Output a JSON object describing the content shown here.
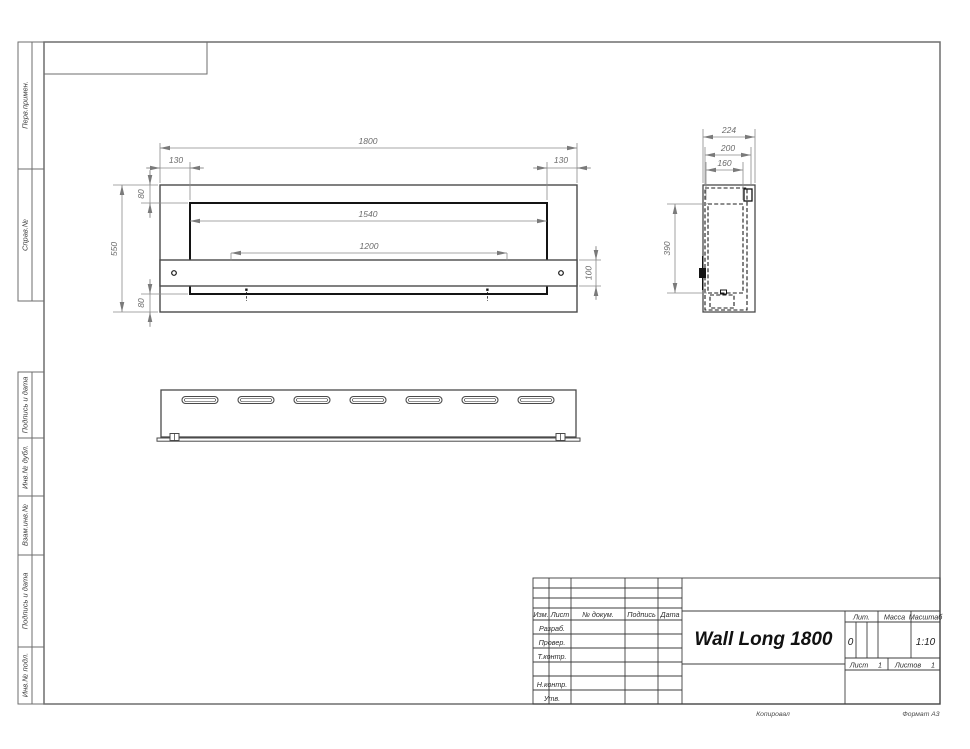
{
  "sheet": {
    "copied_label": "Копировал",
    "format_label": "Формат А3"
  },
  "margin": {
    "boxes": [
      {
        "label": "Перв.примен."
      },
      {
        "label": "Справ.№"
      },
      {
        "label": "Подпись и дата"
      },
      {
        "label": "Инв.№ дубл."
      },
      {
        "label": "Взам.инв.№"
      },
      {
        "label": "Подпись и дата"
      },
      {
        "label": "Инв.№ подл."
      }
    ]
  },
  "title_block": {
    "title": "Wall Long 1800",
    "columns": {
      "izm": "Изм.",
      "list": "Лист",
      "doc": "№ докум.",
      "sign": "Подпись",
      "date": "Дата"
    },
    "rows": {
      "developed": "Разраб.",
      "checked": "Провер.",
      "tcontrol": "Т.контр.",
      "ncontrol": "Н.контр.",
      "approved": "Утв."
    },
    "lit": {
      "label": "Лит.",
      "value": "0"
    },
    "mass": {
      "label": "Масса",
      "value": ""
    },
    "scale": {
      "label": "Масштаб",
      "value": "1:10"
    },
    "sheet_no": {
      "label": "Лист",
      "value": "1"
    },
    "sheets_total": {
      "label": "Листов",
      "value": "1"
    }
  },
  "views": {
    "front": {
      "dims": {
        "overall_width": "1800",
        "inset_left": "130",
        "inset_right": "130",
        "opening_width": "1540",
        "burner_width": "1200",
        "overall_height": "550",
        "top_offset": "80",
        "bottom_offset": "80",
        "strip_height": "100"
      }
    },
    "side": {
      "dims": {
        "depth_overall": "224",
        "depth_outer": "200",
        "depth_inner": "160",
        "inner_height": "390"
      }
    }
  }
}
